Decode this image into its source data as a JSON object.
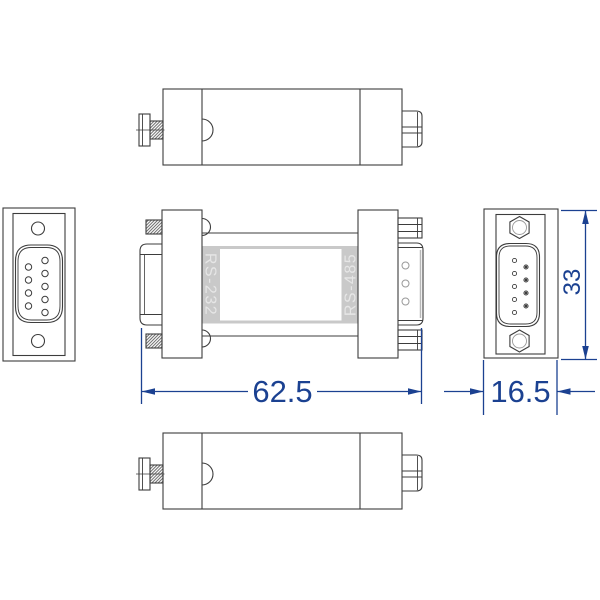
{
  "drawing": {
    "labels": {
      "rs232": "RS-232",
      "rs485": "RS-485"
    },
    "dimensions": {
      "width": "62.5",
      "side_width": "16.5",
      "height": "33"
    },
    "colors": {
      "dimension_blue": "#1b4191",
      "line_dark": "#3d3d3d",
      "line_light": "#999999",
      "shade_gray": "#b8b8b8",
      "hatch": "#5a5a5a",
      "label_gray": "#c9c9c9",
      "label_text": "#e6e6e6",
      "background": "#ffffff"
    }
  }
}
